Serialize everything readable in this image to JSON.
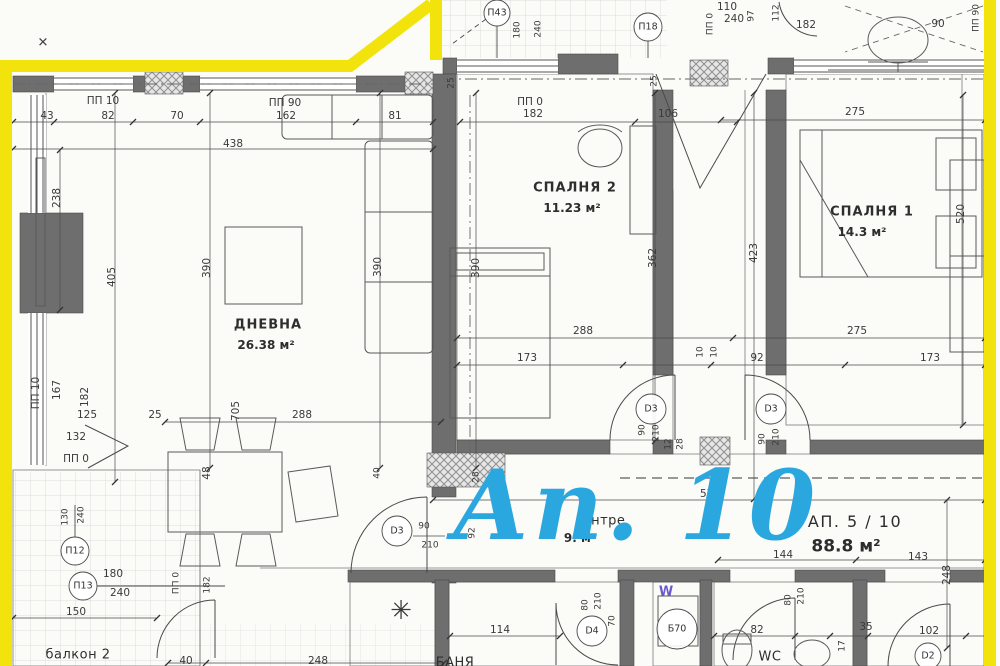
{
  "watermark": {
    "text": "Ап. 10"
  },
  "apartment": {
    "label": "АП. 5 / 10",
    "area": "88.8 м²"
  },
  "rooms": {
    "living": {
      "name": "ДНЕВНА",
      "area": "26.38 м²"
    },
    "bedroom2": {
      "name": "СПАЛНЯ 2",
      "area": "11.23 м²"
    },
    "bedroom1": {
      "name": "СПАЛНЯ 1",
      "area": "14.3 м²"
    },
    "hall": {
      "name": "антре",
      "area": "9. м²"
    },
    "balcony2": {
      "name": "балкон 2"
    },
    "wc": {
      "name": "WC"
    },
    "bath": {
      "name": "БАНЯ"
    }
  },
  "marks": {
    "p43": "П43",
    "p18": "П18",
    "p12": "П12",
    "p13": "П13",
    "d3": "D3",
    "d4": "D4",
    "d2": "D2",
    "b70": "Б70",
    "washer": "W"
  },
  "icons": {
    "ac_star": "✳",
    "x_mark": "✕"
  },
  "colors": {
    "boundary": "#f3e30c",
    "watermark": "#2ba7e0",
    "wall": "#6e6e6e"
  },
  "dims": {
    "d43": "43",
    "d82": "82",
    "d70": "70",
    "d162": "162",
    "d81": "81",
    "d438": "438",
    "d106": "106",
    "d182": "182",
    "d275": "275",
    "d25": "25",
    "d238": "238",
    "d405": "405",
    "d390": "390",
    "d362": "362",
    "d423": "423",
    "d520": "520",
    "d288": "288",
    "d173": "173",
    "d92": "92",
    "d10": "10",
    "d167": "167",
    "d125": "125",
    "d132": "132",
    "d705": "705",
    "d48": "48",
    "d40": "40",
    "d28": "28",
    "d12": "12",
    "d90": "90",
    "d210": "210",
    "d130": "130",
    "d240": "240",
    "d180": "180",
    "d150": "150",
    "d110": "110",
    "d97": "97",
    "d112": "112",
    "d114": "114",
    "d144": "144",
    "d143": "143",
    "d248": "248",
    "d575": "575",
    "d80": "80",
    "d35": "35",
    "d17": "17",
    "d102": "102",
    "pp10": "ПП 10",
    "pp90": "ПП 90",
    "pp0": "ПП 0"
  }
}
